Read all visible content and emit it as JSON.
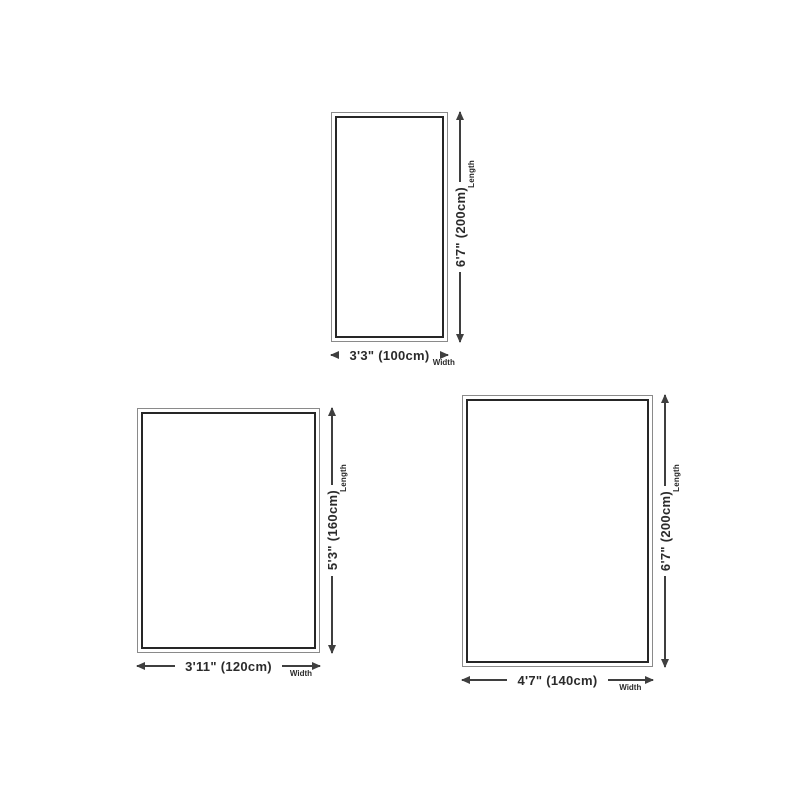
{
  "diagram": {
    "description": "Rug size chart with three rectangular outlines and dimension arrows",
    "colors": {
      "background": "#ffffff",
      "frame_outer": "#8a8a8a",
      "frame_inner": "#262626",
      "arrow": "#3f3f3f",
      "text": "#2b2b2b"
    },
    "length_axis_label": "Length",
    "width_axis_label": "Width",
    "sizes": [
      {
        "id": "100x200",
        "width_label": "3'3\" (100cm)",
        "length_label": "6'7\" (200cm)",
        "width_cm": 100,
        "length_cm": 200
      },
      {
        "id": "120x160",
        "width_label": "3'11\" (120cm)",
        "length_label": "5'3\" (160cm)",
        "width_cm": 120,
        "length_cm": 160
      },
      {
        "id": "140x200",
        "width_label": "4'7\" (140cm)",
        "length_label": "6'7\" (200cm)",
        "width_cm": 140,
        "length_cm": 200
      }
    ]
  }
}
